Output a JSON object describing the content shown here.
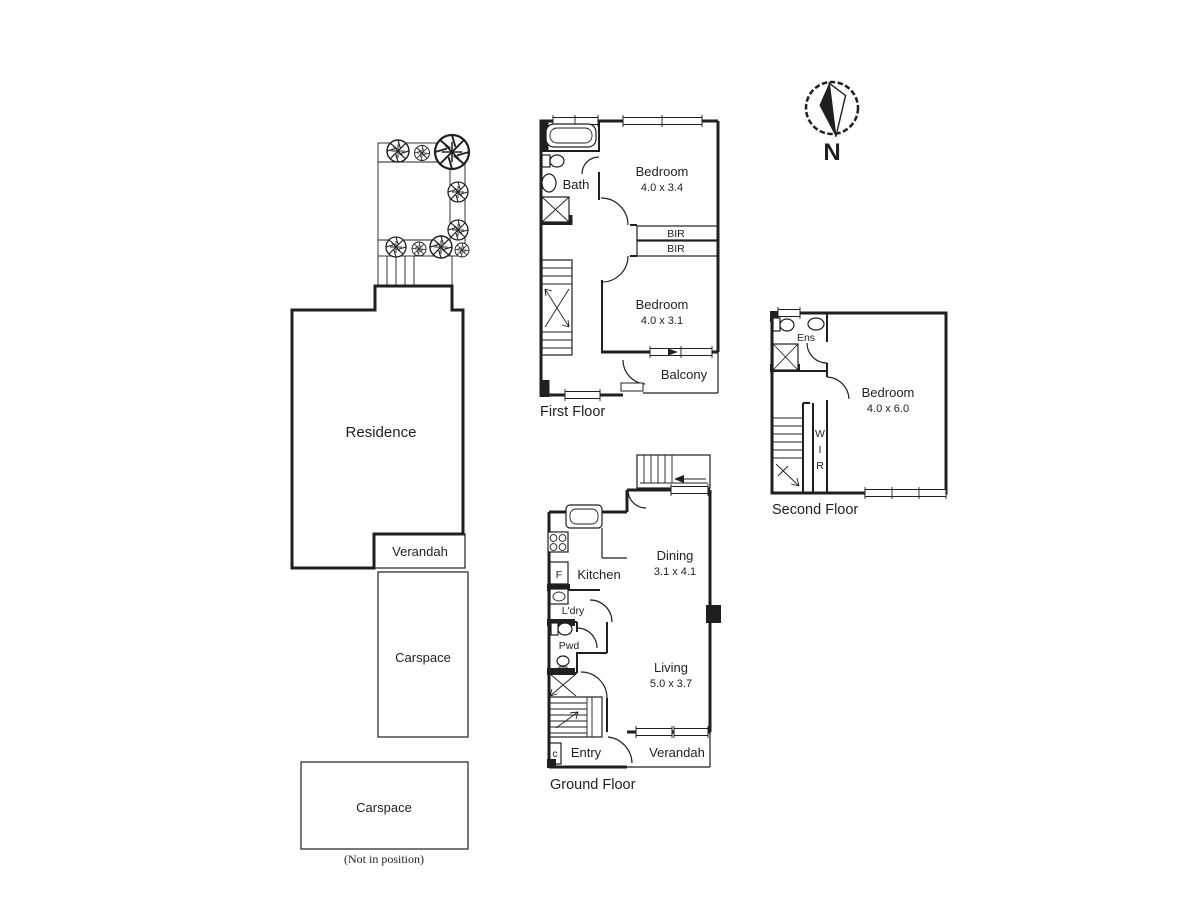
{
  "colors": {
    "ink": "#1f1f1f",
    "background": "#ffffff"
  },
  "compass": {
    "north_label": "N"
  },
  "site_plan": {
    "residence_label": "Residence",
    "verandah_label": "Verandah",
    "carspace1_label": "Carspace",
    "carspace2_label": "Carspace",
    "not_in_position_note": "(Not in position)"
  },
  "first_floor": {
    "title": "First Floor",
    "bath_label": "Bath",
    "bedroom1_label": "Bedroom",
    "bedroom1_dims": "4.0 x 3.4",
    "bir1_label": "BIR",
    "bir2_label": "BIR",
    "bedroom2_label": "Bedroom",
    "bedroom2_dims": "4.0 x 3.1",
    "balcony_label": "Balcony"
  },
  "second_floor": {
    "title": "Second Floor",
    "ens_label": "Ens",
    "bedroom_label": "Bedroom",
    "bedroom_dims": "4.0 x 6.0",
    "wir_letters": [
      "W",
      "I",
      "R"
    ]
  },
  "ground_floor": {
    "title": "Ground Floor",
    "kitchen_label": "Kitchen",
    "fridge_label": "F",
    "dining_label": "Dining",
    "dining_dims": "3.1 x 4.1",
    "laundry_label": "L'dry",
    "powder_label": "Pwd",
    "living_label": "Living",
    "living_dims": "5.0 x 3.7",
    "entry_label": "Entry",
    "cupboard_label": "c",
    "verandah_label": "Verandah"
  }
}
